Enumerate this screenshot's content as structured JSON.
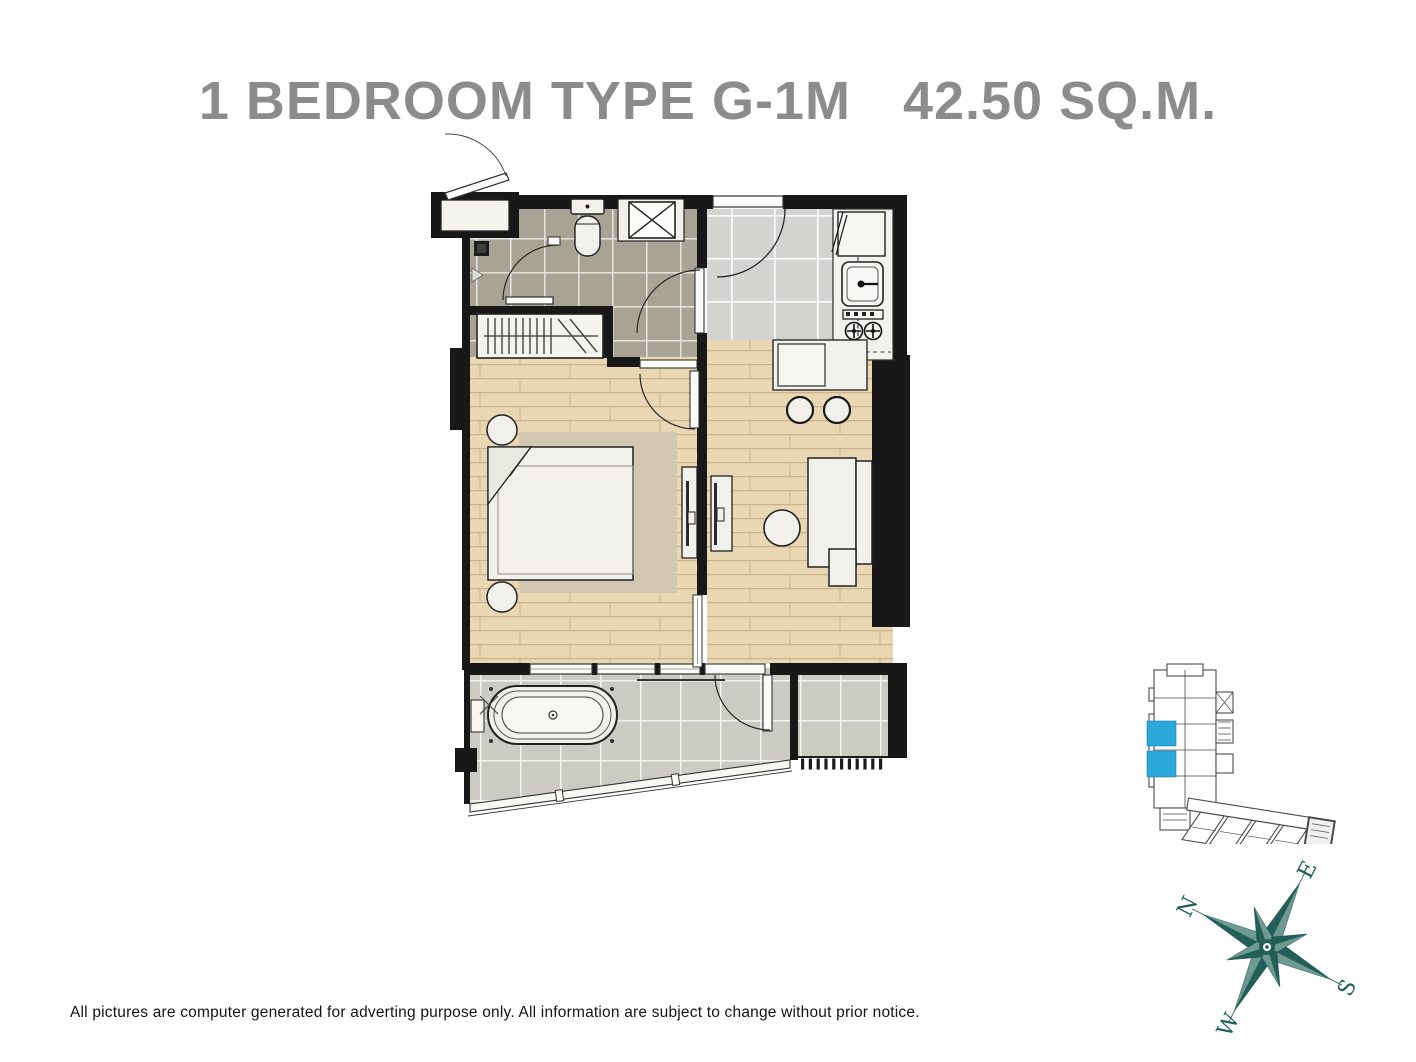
{
  "header": {
    "title_unit": "1 BEDROOM TYPE G-1M",
    "title_area": "42.50 SQ.M.",
    "title_color": "#8c8c8c"
  },
  "footer": {
    "disclaimer": "All pictures are computer generated for adverting purpose only. All information are subject to change without prior notice."
  },
  "compass": {
    "labels": {
      "n": "N",
      "e": "E",
      "s": "S",
      "w": "W"
    },
    "color": "#235f58",
    "rotation_deg": -63
  },
  "key_plan": {
    "highlight_color": "#2ba7d9",
    "highlighted_units": 2,
    "outline_color": "#4a4a4a"
  },
  "floor_plan": {
    "colors": {
      "walls": "#181818",
      "bath_tile": "#a9a396",
      "kitchen_tile": "#d4d3cf",
      "wood_floor": "#e9d6b2",
      "terrace_tile": "#cbcac3",
      "rug": "#d2c7b0",
      "furniture": "#f1f0ea"
    },
    "rooms": [
      "entrance",
      "bathroom",
      "kitchen",
      "bedroom",
      "living-area",
      "terrace",
      "ac-ledge"
    ],
    "fixtures": [
      "toilet",
      "shower",
      "wardrobe",
      "bed",
      "nightstands",
      "tv-consoles",
      "sofa",
      "ottoman",
      "coffee-table",
      "dining-table",
      "stools",
      "fridge",
      "sink",
      "stove",
      "bathtub",
      "louvre-grate"
    ]
  }
}
